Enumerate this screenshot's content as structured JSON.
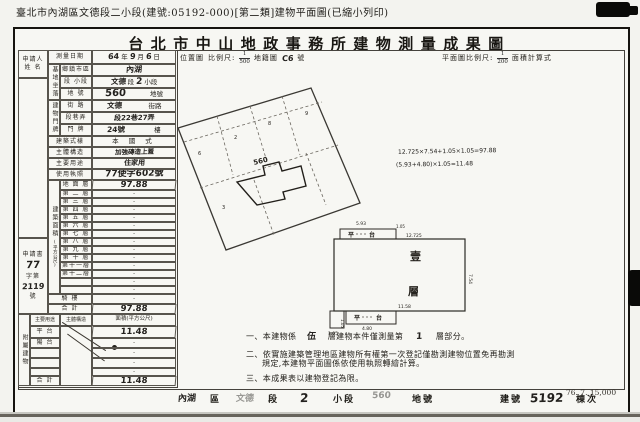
{
  "scan": {
    "page_header": "臺北市內湖區文德段二小段(建號:05192-000)[第二類]建物平面圖(已縮小列印)",
    "print_code": "76. 7. 15,000"
  },
  "title": "台北市中山地政事務所建物測量成果圖",
  "colors": {
    "ink": "#1c1c1c",
    "paper": "#f7f7f3",
    "line": "#57544d"
  },
  "applicant": {
    "l1": "申請人",
    "l2": "姓 名"
  },
  "survey": {
    "label": "測量日期",
    "year": "64",
    "year_unit": "年",
    "month": "9",
    "month_unit": "月",
    "day": "6",
    "day_unit": "日"
  },
  "loc_header": {
    "map_label": "位置圖",
    "scale_label": "比例尺:",
    "num": "1",
    "den": "500",
    "cad_label": "地籍圖",
    "cad_no": "C6",
    "cad_unit": "號"
  },
  "plan_header": {
    "scale_label": "平面圖比例尺:",
    "num": "1",
    "den": "200",
    "formula_label": "面積計算式"
  },
  "site": {
    "group": "基地坐落",
    "district_label": "鄉鎮市區",
    "district": "內湖",
    "section_label": "段 小段",
    "section_pre": "文德",
    "section_mid": "段",
    "section_no": "2",
    "section_suf": "小段",
    "lot_label": "地 號",
    "lot_no": "560",
    "lot_unit": "地號"
  },
  "addr": {
    "group": "建物門牌",
    "street_label": "街 路",
    "street": "文德",
    "street_unit": "街路",
    "lane_label": "段巷弄",
    "lane": "段22巷27弄",
    "door_label": "門 牌",
    "door_no": "24號",
    "door_unit": "樓"
  },
  "attrs": {
    "style_label": "建築式樣",
    "style": "本 國 式",
    "structure_label": "主體構造",
    "structure": "加強磚造上蓋",
    "use_label": "主要用途",
    "use": "住家用",
    "license_label": "使用執照",
    "license": "77使字602號"
  },
  "floor_area": {
    "group": "建築面積",
    "unit": "(平方公尺)",
    "rows": [
      {
        "label": "地 面 層",
        "value": "97.88",
        "hand": true,
        "h": 10
      },
      {
        "label": "第 二 層",
        "value": "·",
        "h": 8
      },
      {
        "label": "第 三 層",
        "value": "·",
        "h": 8
      },
      {
        "label": "第 四 層",
        "value": "·",
        "h": 8
      },
      {
        "label": "第 五 層",
        "value": "·",
        "h": 8
      },
      {
        "label": "第 六 層",
        "value": "·",
        "h": 8
      },
      {
        "label": "第 七 層",
        "value": "·",
        "h": 8
      },
      {
        "label": "第 八 層",
        "value": "·",
        "h": 8
      },
      {
        "label": "第 九 層",
        "value": "·",
        "h": 8
      },
      {
        "label": "第 十 層",
        "value": "·",
        "h": 8
      },
      {
        "label": "第十一層",
        "value": "·",
        "h": 8
      },
      {
        "label": "第十二層",
        "value": "·",
        "h": 8
      },
      {
        "label": "",
        "value": "·",
        "h": 8
      },
      {
        "label": "",
        "value": "·",
        "h": 8
      },
      {
        "label": "騎 樓",
        "value": "·",
        "h": 10,
        "wide": true
      },
      {
        "label": "合 計",
        "value": "97.88",
        "hand": true,
        "h": 10,
        "wide": true
      }
    ]
  },
  "annex": {
    "group": "附屬建物",
    "col_use": "主要用途",
    "col_structure": "主體構造",
    "col_area": "面積(平方公尺)",
    "rows": [
      {
        "label": "平 台",
        "value": "11.48",
        "hand": true,
        "h": 12
      },
      {
        "label": "陽 台",
        "value": "·",
        "h": 10
      },
      {
        "label": "",
        "value": "·",
        "h": 10
      },
      {
        "label": "",
        "value": "·",
        "h": 10
      },
      {
        "label": "",
        "value": "·",
        "h": 8
      },
      {
        "label": "合 計",
        "value": "11.48",
        "hand": true,
        "h": 10
      }
    ]
  },
  "stamp": {
    "l1": "申請書",
    "no1": "77",
    "l2": "字第",
    "no2": "2119",
    "l3": "號"
  },
  "formulas": {
    "f1": "12.725×7.54+1.05×1.05=97.88",
    "f2": "(5.93+4.80)×1.05=11.48"
  },
  "location_map": {
    "lot": "560",
    "marks": [
      "6",
      "2",
      "8",
      "9",
      "3"
    ]
  },
  "floor_plan": {
    "floor_top": "壹",
    "floor_bottom": "層",
    "pt1": "平",
    "pt2": "台",
    "dims": {
      "top_platform": "5.93",
      "platform_depth": "1.05",
      "top": "12.725",
      "right": "7.54",
      "bottom": "11.58",
      "bottom_platform": "4.80",
      "bottom_depth": "1.05",
      "corner": "1.05"
    }
  },
  "notes": {
    "n1a": "一、本建物係",
    "n1b": "伍",
    "n1c": "層建物本件僅測量第",
    "n1d": "1",
    "n1e": "層部分。",
    "n2a": "二、依實施建築管理地區建物所有權第一次登記僅勘測建物位置免再勘測",
    "n2b": "規定,本建物平面圖係依使用執照轉繪計算。",
    "n3": "三、本成果表以建物登記為限。"
  },
  "bottom_strip": {
    "items": [
      {
        "t": "內湖",
        "hand": true
      },
      {
        "t": "區"
      },
      {
        "t": "文德",
        "hand": true,
        "faint": true
      },
      {
        "t": "段"
      },
      {
        "t": "2",
        "hand": true,
        "big": true
      },
      {
        "t": "小段"
      },
      {
        "t": "560",
        "hand": true,
        "faint": true
      },
      {
        "t": "地號"
      },
      {
        "t": "建號"
      },
      {
        "t": "5192",
        "hand": true,
        "big": true
      },
      {
        "t": "棟次"
      }
    ]
  }
}
